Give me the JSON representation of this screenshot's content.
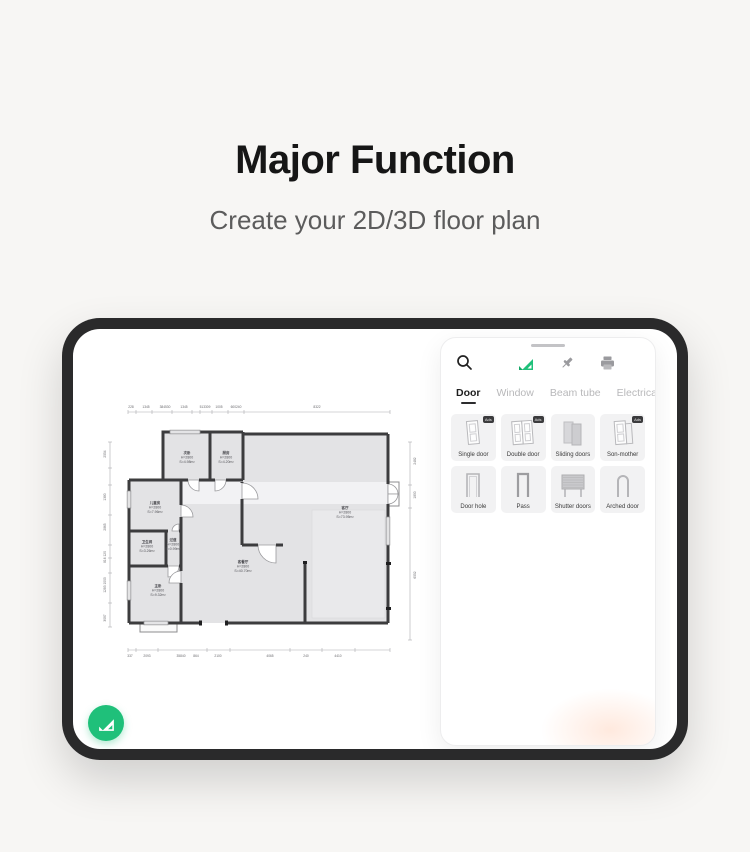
{
  "page": {
    "title": "Major Function",
    "subtitle": "Create your 2D/3D floor plan"
  },
  "panel": {
    "toolbar_icons": [
      "search",
      "app-logo",
      "pin",
      "printer"
    ],
    "tabs": [
      {
        "label": "Door",
        "active": true
      },
      {
        "label": "Window",
        "active": false
      },
      {
        "label": "Beam tube",
        "active": false
      },
      {
        "label": "Electrical",
        "active": false
      },
      {
        "label": "Water",
        "active": false
      }
    ],
    "badge_text": "Ads",
    "items": [
      {
        "label": "Single door",
        "badge": true
      },
      {
        "label": "Double door",
        "badge": true
      },
      {
        "label": "Sliding doors",
        "badge": false
      },
      {
        "label": "Son-mother",
        "badge": true
      },
      {
        "label": "Door hole",
        "badge": false
      },
      {
        "label": "Pass",
        "badge": false
      },
      {
        "label": "Shutter doors",
        "badge": false
      },
      {
        "label": "Arched door",
        "badge": false
      }
    ]
  },
  "floor_plan": {
    "rooms": [
      {
        "name": "次卧",
        "height": "H=2800",
        "area": "S=4.98m²"
      },
      {
        "name": "厨房",
        "height": "H=2800",
        "area": "S=4.20m²"
      },
      {
        "name": "儿童房",
        "height": "H=2800",
        "area": "S=7.96m²"
      },
      {
        "name": "卫生间",
        "height": "H=2800",
        "area": "S=3.26m²"
      },
      {
        "name": "过道",
        "height": "H=2800",
        "area": "S=0.99m²"
      },
      {
        "name": "主卧",
        "height": "H=2800",
        "area": "S=9.32m²"
      },
      {
        "name": "客餐厅",
        "height": "H=2800",
        "area": "S=40.70m²"
      },
      {
        "name": "客厅",
        "height": "H=2800",
        "area": "S=73.95m²"
      }
    ],
    "dims_top": [
      "228",
      "1345",
      "384530",
      "1345",
      "513309",
      "1005",
      "600240",
      "8322"
    ],
    "dims_bottom": [
      "337",
      "2093",
      "35840",
      "864",
      "2100",
      "4065",
      "240",
      "4410"
    ],
    "dims_left": [
      "2554",
      "1380",
      "2865",
      "816 120",
      "1283 1000",
      "3097"
    ],
    "dims_right": [
      "2482",
      "1800",
      "6552"
    ]
  },
  "colors": {
    "page_bg": "#f7f6f4",
    "frame": "#2a2a2b",
    "wall": "#3c3c3e",
    "room_fill": "#e3e3e5",
    "accent_green": "#1fc07a"
  }
}
